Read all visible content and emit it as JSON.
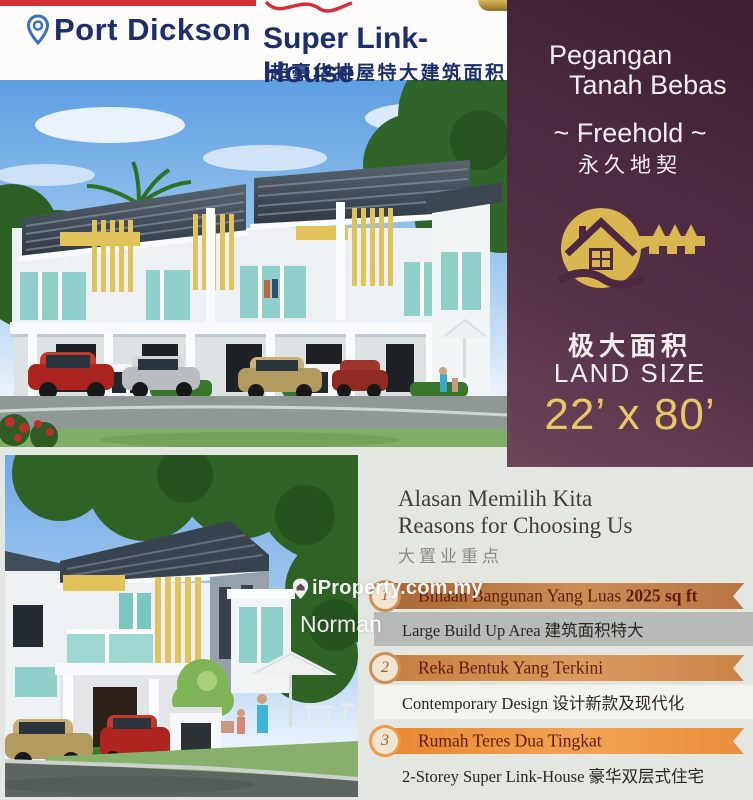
{
  "header": {
    "location": "Port Dickson",
    "title": "Super Link-House",
    "subtitle_cn": "超豪华排屋特大建筑面积"
  },
  "sidebar": {
    "tenure_line1": "Pegangan",
    "tenure_line2": "Tanah Bebas",
    "freehold": "~ Freehold ~",
    "freehold_cn": "永久地契",
    "area_cn": "极大面积",
    "land_size_label": "LAND SIZE",
    "land_size_value": "22’ x 80’"
  },
  "reasons": {
    "title_ms": "Alasan Memilih Kita",
    "title_en": "Reasons for Choosing Us",
    "title_cn": "大置业重点",
    "items": [
      {
        "num": "1",
        "heading": "Binaan Bangunan Yang Luas ",
        "heading_bold": "2025 sq ft",
        "detail": "Large Build Up Area 建筑面积特大"
      },
      {
        "num": "2",
        "heading": "Reka Bentuk Yang Terkini",
        "heading_bold": "",
        "detail": "Contemporary Design 设计新款及现代化"
      },
      {
        "num": "3",
        "heading": "Rumah Teres Dua Tingkat",
        "heading_bold": "",
        "detail": "2-Storey Super Link-House 豪华双层式住宅"
      }
    ]
  },
  "watermark": {
    "brand": "iProperty.com.my",
    "agent": "Norman"
  },
  "colors": {
    "sidebar_plum": "#4c2940",
    "gold": "#e8c667",
    "navy": "#1d2e6d",
    "ribbon_orange": "#ea8e3c",
    "red_accent": "#d53238"
  }
}
